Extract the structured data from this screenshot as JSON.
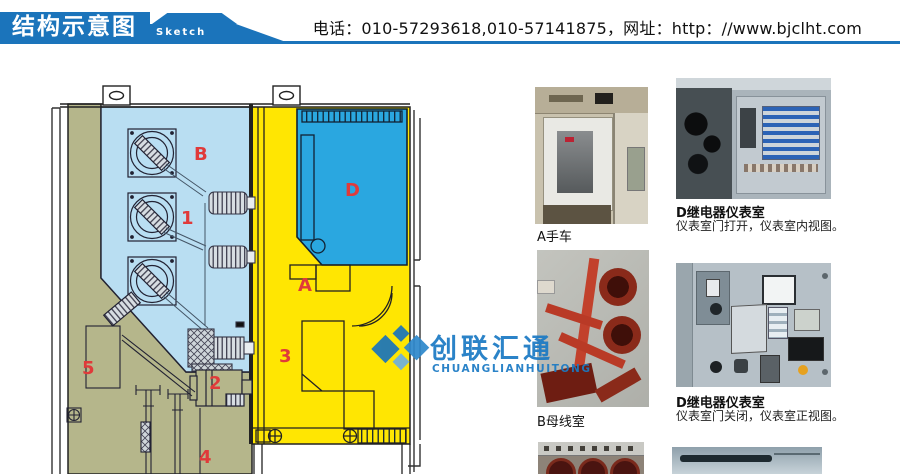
{
  "header": {
    "title_cn": "结构示意图",
    "title_en": "Sketch Map",
    "contact": "电话：010-57293618,010-57141875，网址：http：//www.bjclht.com",
    "banner_color": "#1b74bb"
  },
  "watermark": {
    "name_cn": "创联汇通",
    "name_en": "CHUANGLIANHUITONG",
    "color": "#1b7ac4"
  },
  "diagram": {
    "part_labels": [
      "B",
      "1",
      "D",
      "A",
      "3",
      "5",
      "2",
      "4"
    ],
    "colors": {
      "busbar_room_fill": "#b9def2",
      "breaker_room_fill": "#ffe602",
      "instrument_room_fill": "#2aa7e0",
      "cable_room_fill": "#b5b68b",
      "label_red": "#e03a3a"
    }
  },
  "photos": [
    {
      "caption": "A手车"
    },
    {
      "caption": "D继电器仪表室",
      "subcaption": "仪表室门打开，仪表室内视图。"
    },
    {
      "caption": "B母线室"
    },
    {
      "caption": "D继电器仪表室",
      "subcaption": "仪表室门关闭，仪表室正视图。"
    }
  ]
}
